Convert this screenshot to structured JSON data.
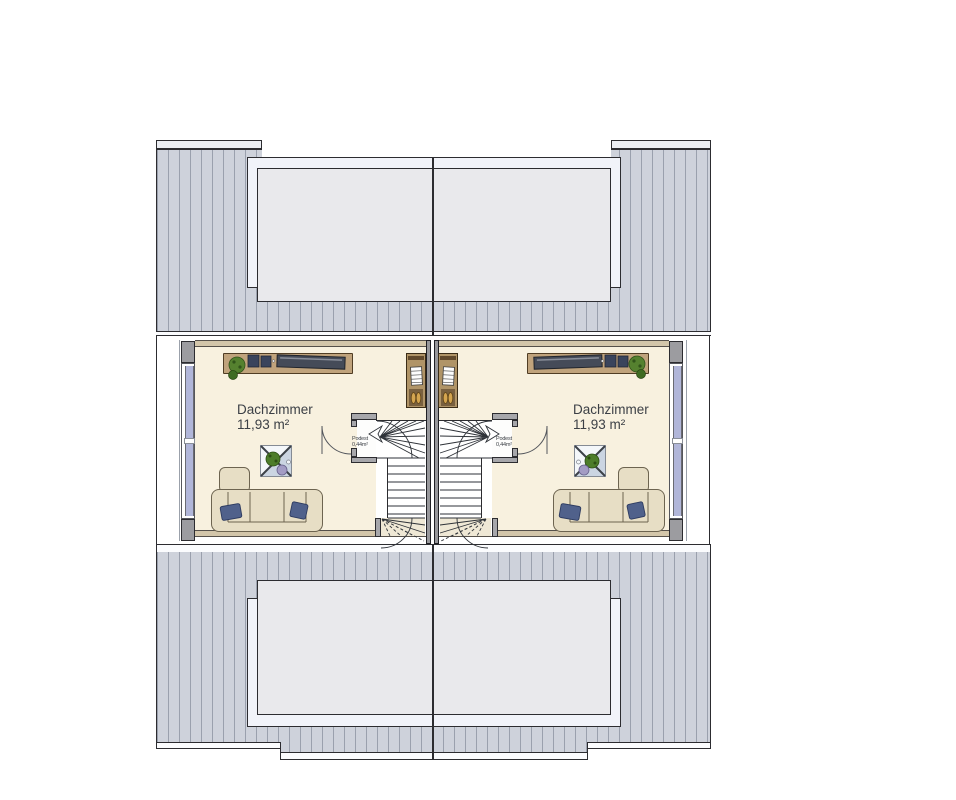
{
  "rooms": [
    {
      "name": "Dachzimmer",
      "area": "11,93 m²"
    },
    {
      "name": "Dachzimmer",
      "area": "11,93 m²"
    }
  ],
  "landings": [
    {
      "label": "Podest",
      "area": "0,44m²"
    },
    {
      "label": "Podest",
      "area": "0,44m²"
    }
  ],
  "colors": {
    "roof_field": "#ced2db",
    "roof_seam": "#9aa0ad",
    "dormer_outer": "#f1f3f9",
    "dormer_inner": "#e9e9ec",
    "floor": "#f8f1df",
    "knee_wall": "#d3c6aa",
    "masonry_wall": "#9c9ca0",
    "party_wall": "#97979b",
    "window_glass": "#b1b6d9",
    "wood_furniture": "#c0a37c",
    "sofa": "#e7dec5",
    "cushion": "#50618b",
    "plant": "#4d7d2a",
    "outline": "#2c2c30",
    "text": "#3c4046"
  },
  "icons": {
    "stair_direction_arrow": "notched-arrow",
    "door_swing": "quarter-arc",
    "roof_window": "crossed-square"
  }
}
